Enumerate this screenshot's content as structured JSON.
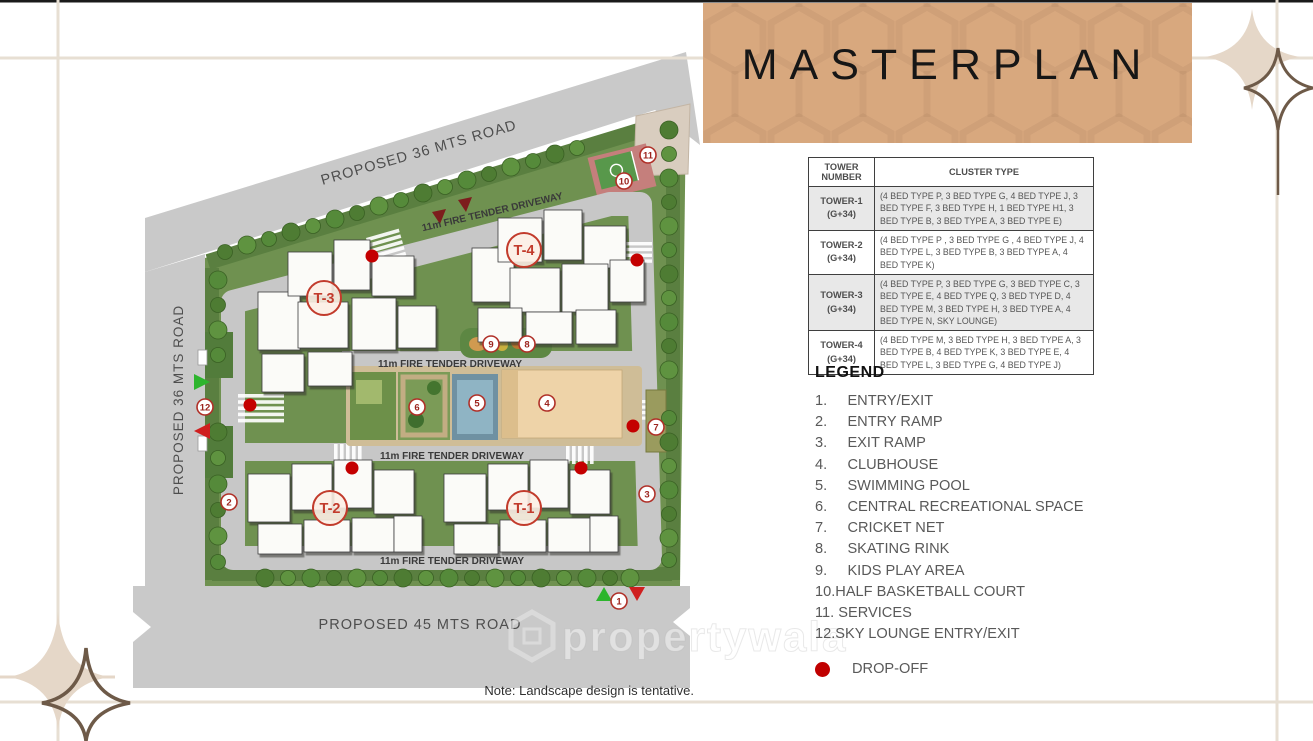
{
  "title": "MASTERPLAN",
  "plan": {
    "roads": {
      "top": "PROPOSED 36 MTS ROAD",
      "left": "PROPOSED 36 MTS ROAD",
      "bottom": "PROPOSED 45 MTS ROAD"
    },
    "driveway": "11m FIRE TENDER DRIVEWAY",
    "towers": [
      "T-1",
      "T-2",
      "T-3",
      "T-4"
    ],
    "markers": [
      "1",
      "2",
      "3",
      "4",
      "5",
      "6",
      "7",
      "8",
      "9",
      "10",
      "11",
      "12"
    ],
    "note": "Note: Landscape design is tentative.",
    "watermark": "propertywala"
  },
  "table": {
    "headers": {
      "tower": "TOWER NUMBER",
      "cluster": "CLUSTER TYPE"
    },
    "rows": [
      {
        "tower": "TOWER-1",
        "floors": "(G+34)",
        "cluster": "(4 BED TYPE P, 3 BED TYPE G, 4 BED TYPE J, 3 BED TYPE F, 3 BED TYPE H, 1 BED TYPE H1, 3 BED TYPE B, 3 BED TYPE A, 3 BED TYPE E)"
      },
      {
        "tower": "TOWER-2",
        "floors": "(G+34)",
        "cluster": "(4 BED TYPE P , 3 BED TYPE G , 4 BED TYPE J, 4 BED TYPE L, 3 BED TYPE B, 3 BED TYPE A, 4 BED TYPE K)"
      },
      {
        "tower": "TOWER-3",
        "floors": "(G+34)",
        "cluster": "(4 BED TYPE P, 3 BED TYPE G, 3 BED TYPE C, 3 BED TYPE E, 4 BED TYPE Q, 3 BED TYPE D, 4 BED TYPE M, 3 BED TYPE H, 3 BED TYPE A, 4 BED TYPE N, SKY LOUNGE)"
      },
      {
        "tower": "TOWER-4",
        "floors": "(G+34)",
        "cluster": "(4 BED TYPE M, 3 BED TYPE H, 3 BED TYPE A, 3 BED TYPE B, 4 BED TYPE K, 3 BED TYPE E, 4 BED TYPE L, 3 BED TYPE G, 4 BED TYPE J)"
      }
    ]
  },
  "legend": {
    "heading": "LEGEND",
    "items": [
      "1.     ENTRY/EXIT",
      "2.     ENTRY RAMP",
      "3.     EXIT RAMP",
      "4.     CLUBHOUSE",
      "5.     SWIMMING POOL",
      "6.     CENTRAL RECREATIONAL SPACE",
      "7.     CRICKET NET",
      "8.     SKATING RINK",
      "9.     KIDS PLAY AREA",
      "10.HALF BASKETBALL COURT",
      "11. SERVICES",
      "12.SKY LOUNGE ENTRY/EXIT"
    ],
    "drop_off": "DROP-OFF"
  },
  "colors": {
    "panel_tan": "#d8a87e",
    "accent_red": "#c00000",
    "road_gray": "#c9c9c9",
    "site_green": "#6f9150",
    "clubhouse_beige": "#eed3a8",
    "pool_blue": "#6f91a2"
  }
}
